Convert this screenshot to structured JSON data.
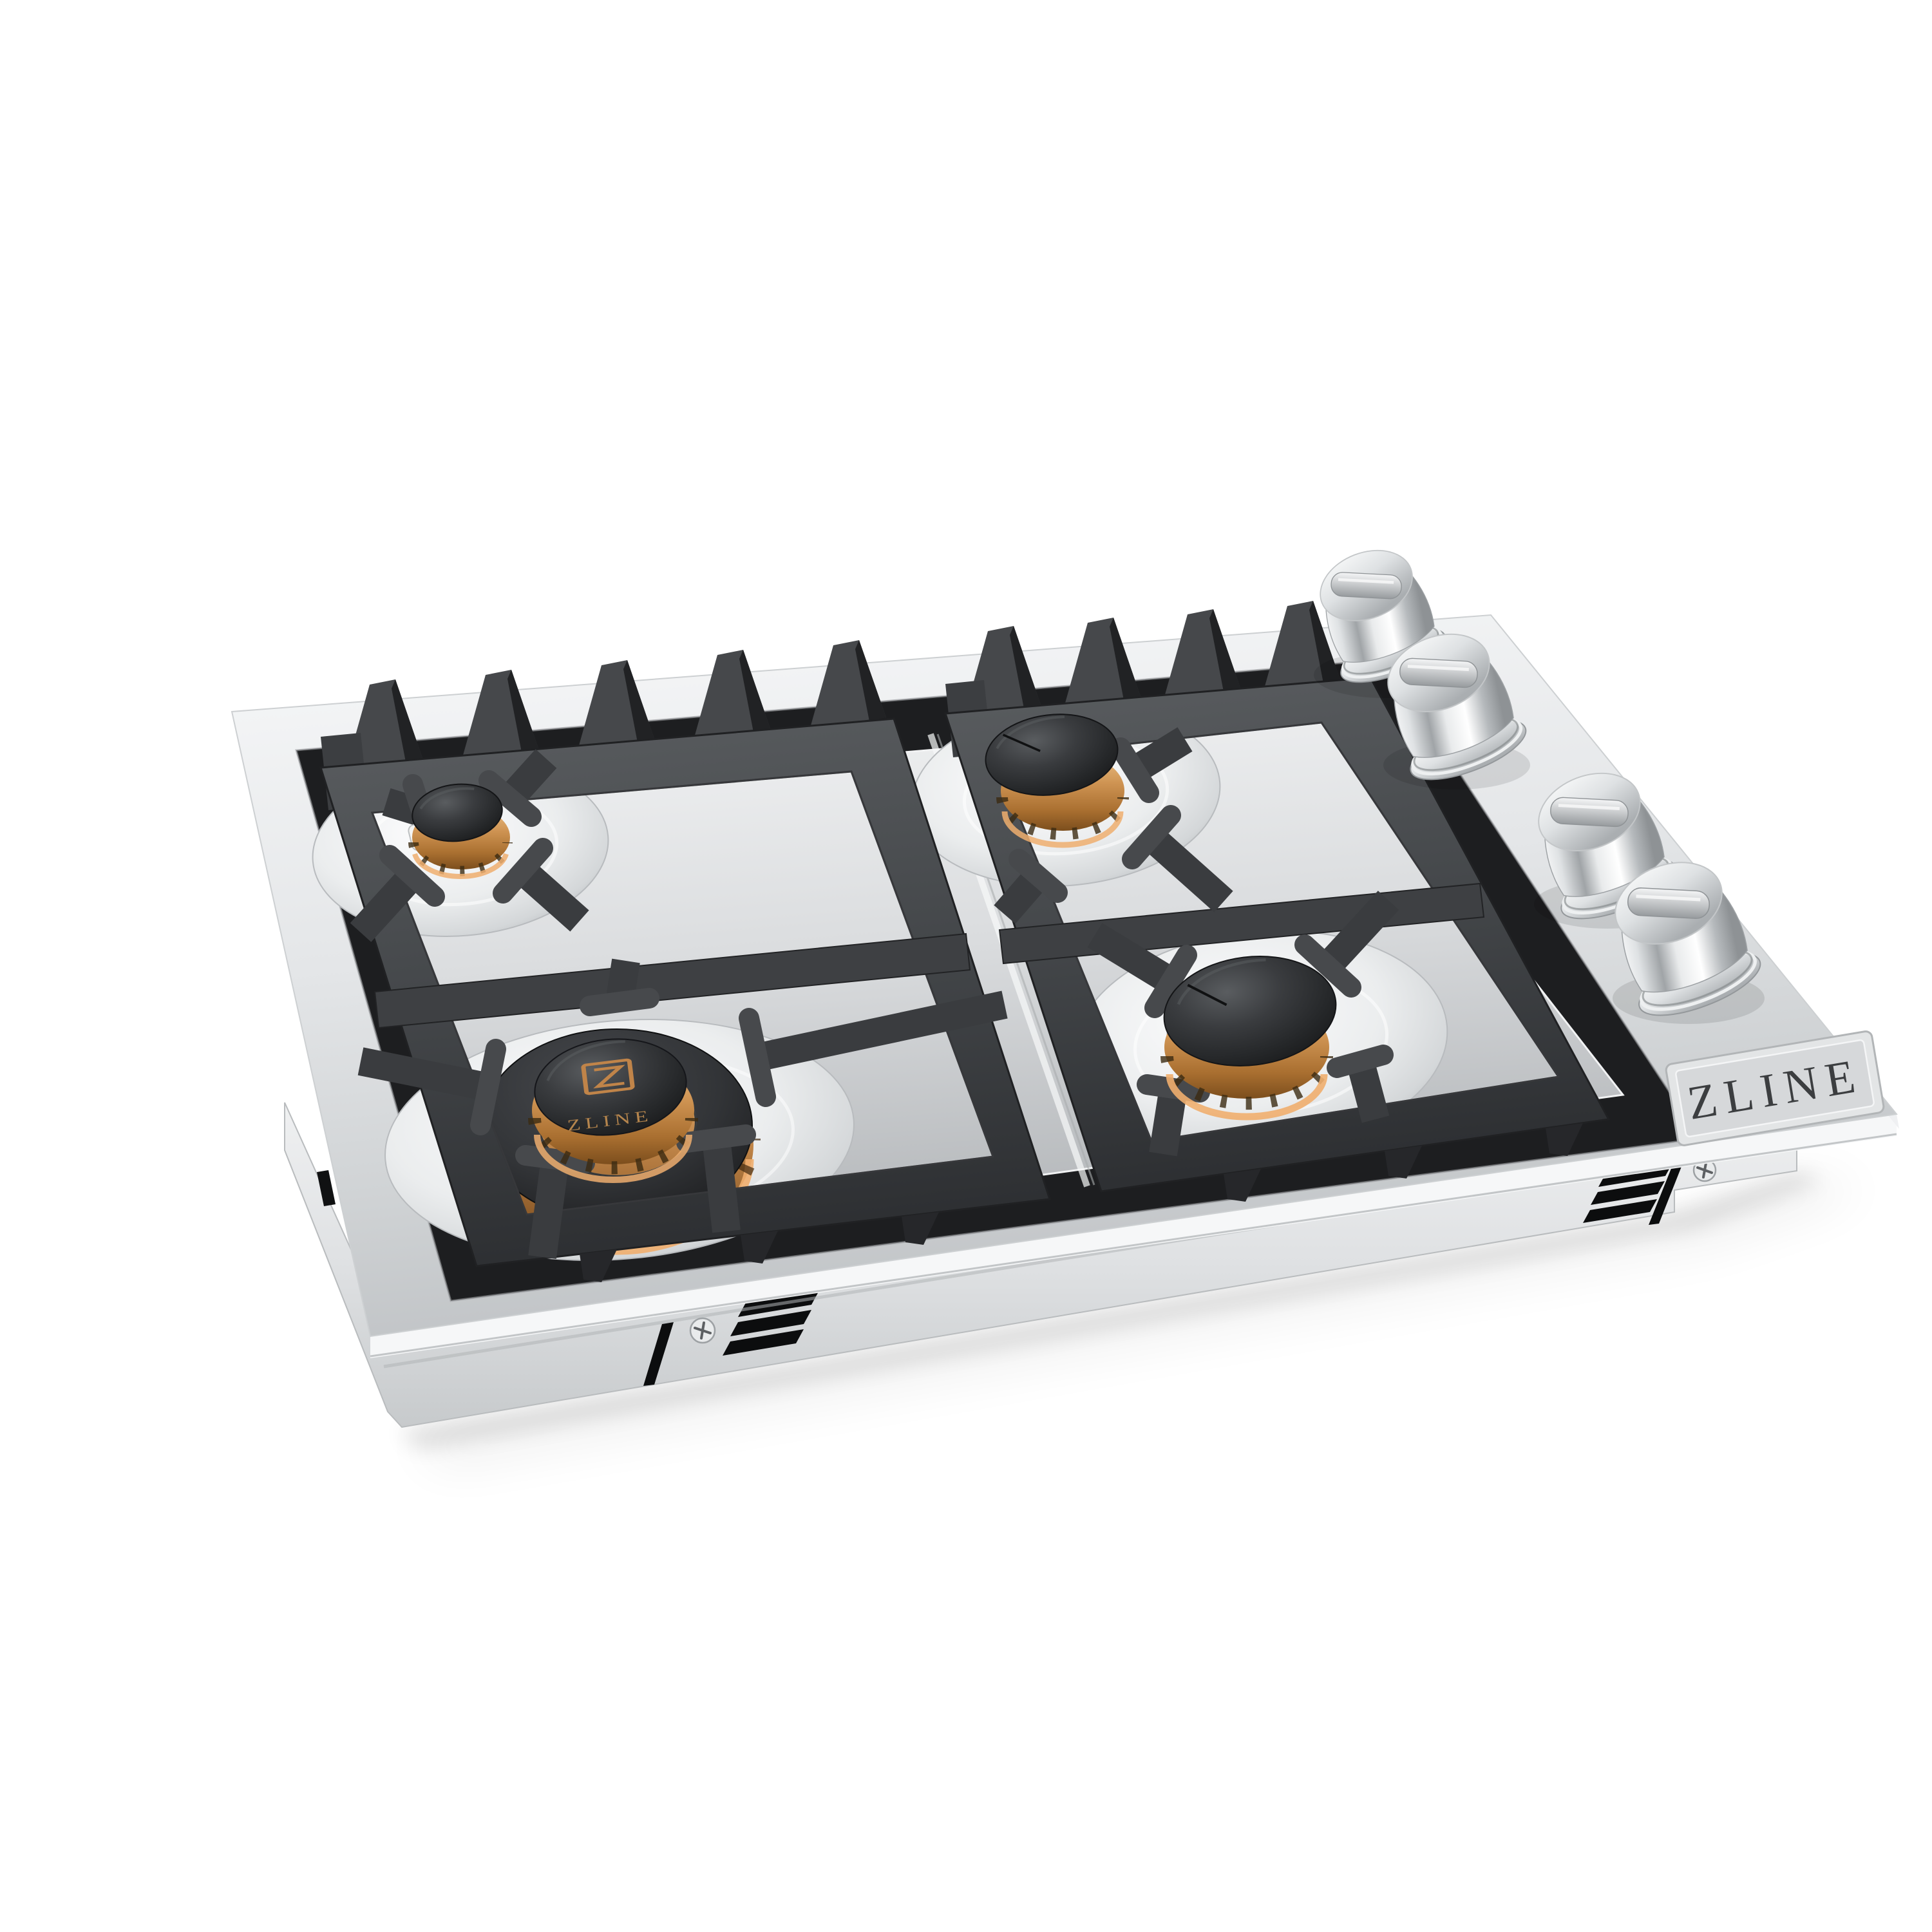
{
  "product": {
    "brand": "ZLINE",
    "badge_text": "ZLINE",
    "burner_cap_logo_text": "ZLINE",
    "description": "Stainless steel drop-in gas cooktop, three-quarter product photo: 4 sealed brass burners with black caps, 2 black cast-iron grates, 4 chrome control knobs, ZLINE badge on right edge"
  },
  "scene": {
    "background_color": "#ffffff",
    "shadow_color": "rgba(0,0,0,0.14)"
  },
  "colors": {
    "stainless_light": "#f4f5f6",
    "stainless_mid": "#d9dbdd",
    "stainless_dark": "#b7babd",
    "cast_iron": "#44474a",
    "rim_black": "#1d1e20",
    "brass": "#c98f4e",
    "copper_band": "#efae6e",
    "cap_black": "#2c2e30",
    "chrome_knob": "#e6e8ea",
    "badge_plate": "#dcdee0",
    "badge_text_color": "#3c3e40"
  },
  "components": {
    "burners": [
      {
        "id": "rear-left",
        "size": "small",
        "cap_color": "black",
        "body": "brass",
        "igniter_visible": true
      },
      {
        "id": "rear-right",
        "size": "medium",
        "cap_color": "black",
        "body": "brass",
        "igniter_visible": true
      },
      {
        "id": "front-right",
        "size": "medium-large",
        "cap_color": "black",
        "body": "brass",
        "igniter_visible": true
      },
      {
        "id": "front-left",
        "size": "large-dual-ring",
        "cap_color": "black",
        "body": "brass",
        "logo_on_cap": "ZLINE"
      }
    ],
    "grates": {
      "count": 2,
      "finish": "matte black cast iron"
    },
    "control_knobs": {
      "count": 4,
      "finish": "chrome"
    },
    "vent_groups": {
      "count": 2,
      "slots_per_group": 3
    },
    "visible_screws": 2
  }
}
